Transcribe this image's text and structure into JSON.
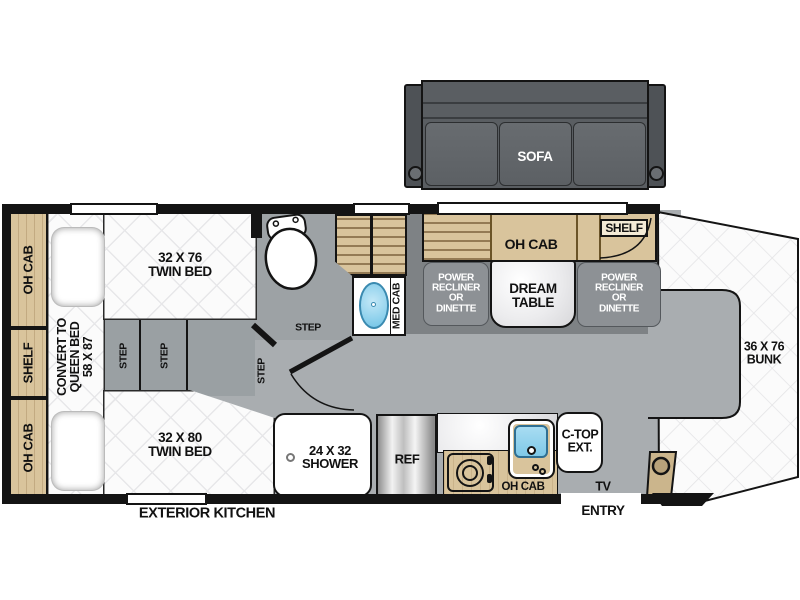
{
  "plan_title": "motorhome floorplan",
  "colors": {
    "wall": "#141414",
    "floor": "#a9adb0",
    "wood": "#d9c49c",
    "sink_blue": "#82cbea",
    "recliner_gray": "#8d9195"
  },
  "sofa": {
    "label": "SOFA"
  },
  "left_wall": {
    "oh_cab_top": "OH CAB",
    "shelf": "SHELF",
    "oh_cab_bottom": "OH CAB"
  },
  "beds": {
    "twin_top": {
      "line1": "32 X 76",
      "line2": "TWIN BED"
    },
    "twin_bottom": {
      "line1": "32 X 80",
      "line2": "TWIN BED"
    },
    "queen_convert": {
      "line1": "CONVERT TO",
      "line2": "QUEEN BED",
      "line3": "58 X 87"
    },
    "bunk": {
      "line1": "36 X 76",
      "line2": "BUNK"
    }
  },
  "steps": {
    "step": "STEP"
  },
  "bath": {
    "shower": {
      "line1": "24 X 32",
      "line2": "SHOWER"
    },
    "med_cab": "MED CAB"
  },
  "dinette": {
    "oh_cab": "OH CAB",
    "shelf": "SHELF",
    "recliner": {
      "line1": "POWER",
      "line2": "RECLINER",
      "line3": "OR",
      "line4": "DINETTE"
    },
    "table": {
      "line1": "DREAM",
      "line2": "TABLE"
    }
  },
  "kitchen": {
    "ref": "REF",
    "oh_cab": "OH CAB",
    "ctop": {
      "line1": "C-TOP",
      "line2": "EXT."
    },
    "exterior": "EXTERIOR KITCHEN"
  },
  "entry_area": {
    "tv": "TV",
    "entry": "ENTRY"
  }
}
